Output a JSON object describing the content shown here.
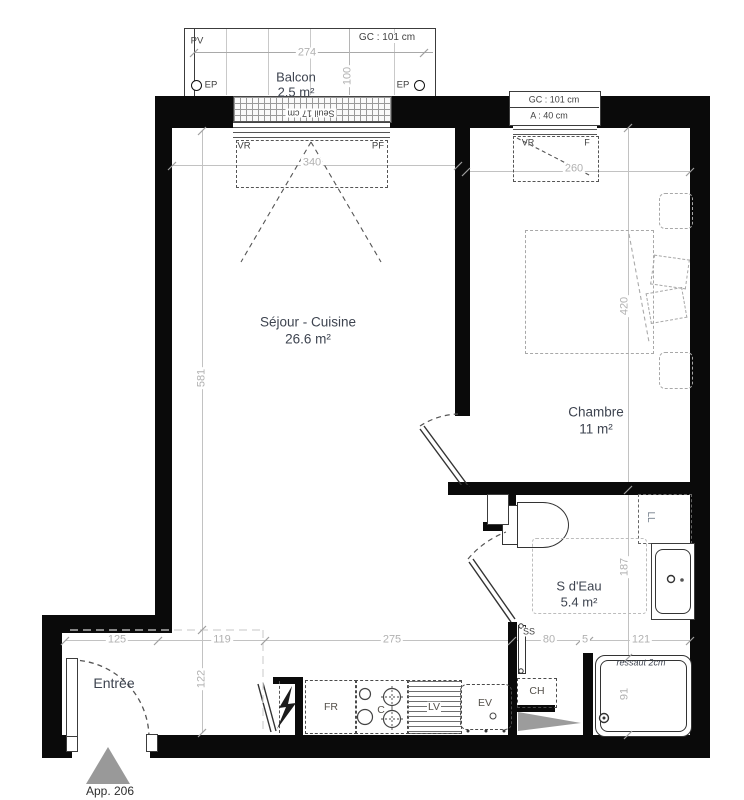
{
  "meta": {
    "apartment_label": "App. 206"
  },
  "rooms": {
    "balcon": {
      "name": "Balcon",
      "area": "2.5 m²"
    },
    "sejour": {
      "name": "Séjour - Cuisine",
      "area": "26.6 m²"
    },
    "chambre": {
      "name": "Chambre",
      "area": "11 m²"
    },
    "sdeau": {
      "name": "S d'Eau",
      "area": "5.4 m²"
    },
    "entree": {
      "name": "Entrée"
    }
  },
  "openings": {
    "balcony_window": {
      "pv": "PV",
      "gc": "GC : 101 cm",
      "seuil": "Seuil 17 cm",
      "vr": "VR",
      "pf": "PF",
      "ep_left": "EP",
      "ep_right": "EP"
    },
    "bedroom_window": {
      "gc": "GC : 101 cm",
      "allege": "A : 40 cm",
      "vr": "VR",
      "f": "F"
    }
  },
  "equipment": {
    "fr": "FR",
    "cooktop": "C",
    "lv": "LV",
    "ev": "EV",
    "ch": "CH",
    "ss": "SS",
    "ll": "LL",
    "ressaut": "ressaut 2cm"
  },
  "dimensions": {
    "balcony_width": "274",
    "balcony_depth": "100",
    "sejour_width": "340",
    "chambre_width": "260",
    "sejour_height": "581",
    "chambre_height": "420",
    "sdeau_height": "187",
    "entree_width": "125",
    "hall_width": "119",
    "kitchen_width": "275",
    "ch_width": "80",
    "wall_width": "5",
    "shower_width": "121",
    "entree_depth": "122",
    "shower_height": "91"
  },
  "colors": {
    "wall": "#0a0a0a",
    "dim": "#b1b1b1",
    "room_label": "#3e4450",
    "annotation": "#3f3f3f",
    "gray_fill": "#9c9c9c"
  }
}
